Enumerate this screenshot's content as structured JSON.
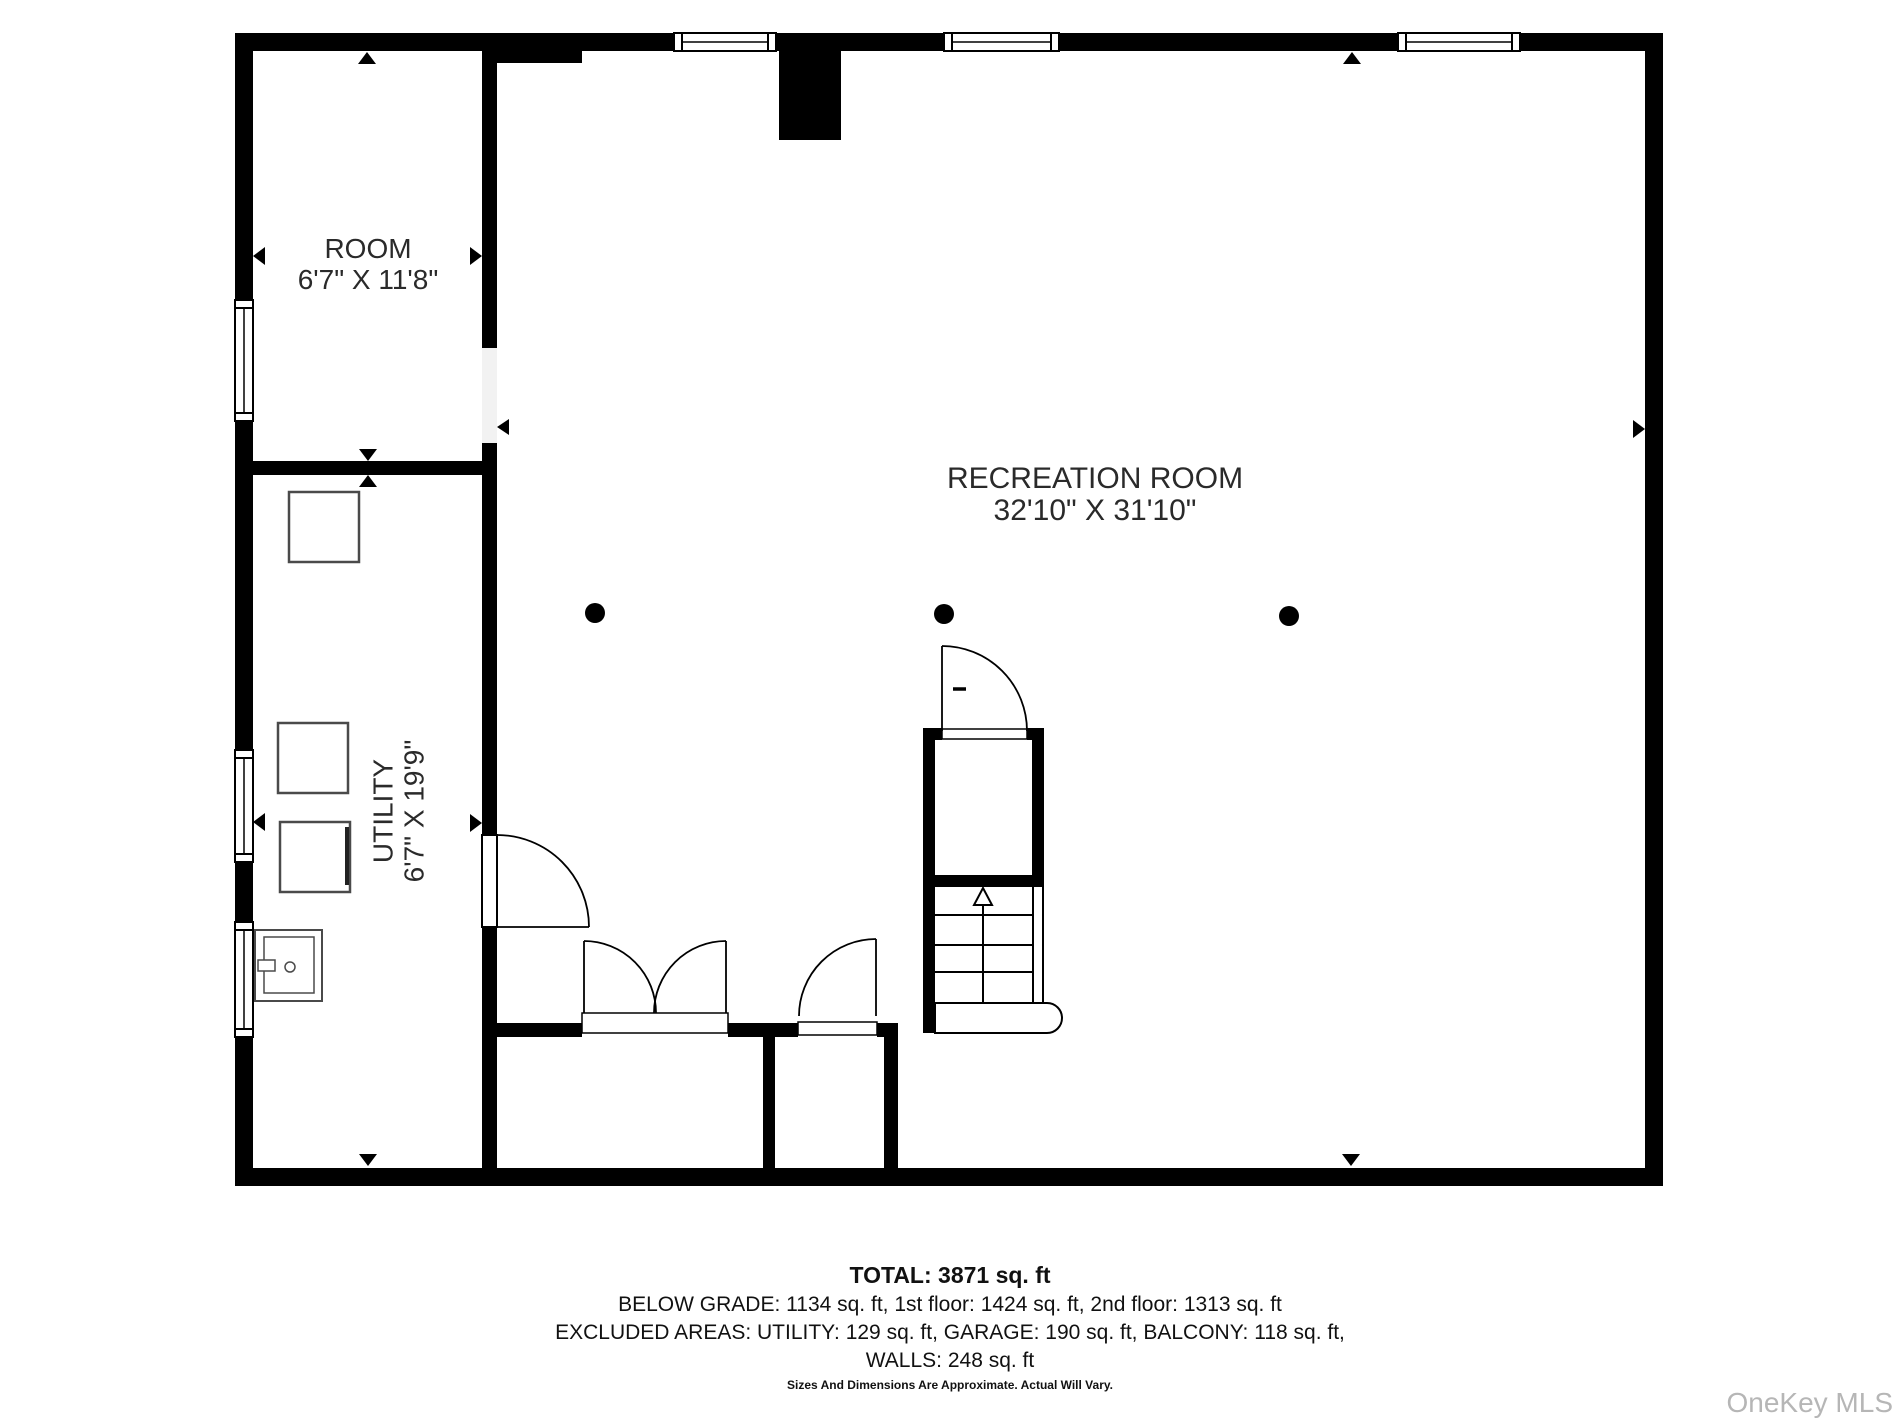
{
  "floorplan": {
    "rooms": {
      "room": {
        "name": "ROOM",
        "dimensions": "6'7\" X 11'8\""
      },
      "recreation": {
        "name": "RECREATION ROOM",
        "dimensions": "32'10\" X 31'10\""
      },
      "utility": {
        "name": "UTILITY",
        "dimensions": "6'7\" X 19'9\""
      }
    },
    "colors": {
      "wall": "#000000",
      "label_text": "#2a2a2a",
      "fixture_stroke": "#4a4a4a",
      "watermark": "#b6b6b6"
    }
  },
  "footer": {
    "total": "TOTAL: 3871 sq. ft",
    "grade_line": "BELOW GRADE: 1134 sq. ft, 1st floor: 1424 sq. ft, 2nd floor: 1313 sq. ft",
    "excluded_line": "EXCLUDED AREAS: UTILITY: 129 sq. ft, GARAGE: 190 sq. ft, BALCONY: 118 sq. ft,",
    "walls_line": "WALLS: 248 sq. ft",
    "disclaimer": "Sizes And Dimensions Are Approximate. Actual Will Vary."
  },
  "watermark": "OneKey MLS"
}
